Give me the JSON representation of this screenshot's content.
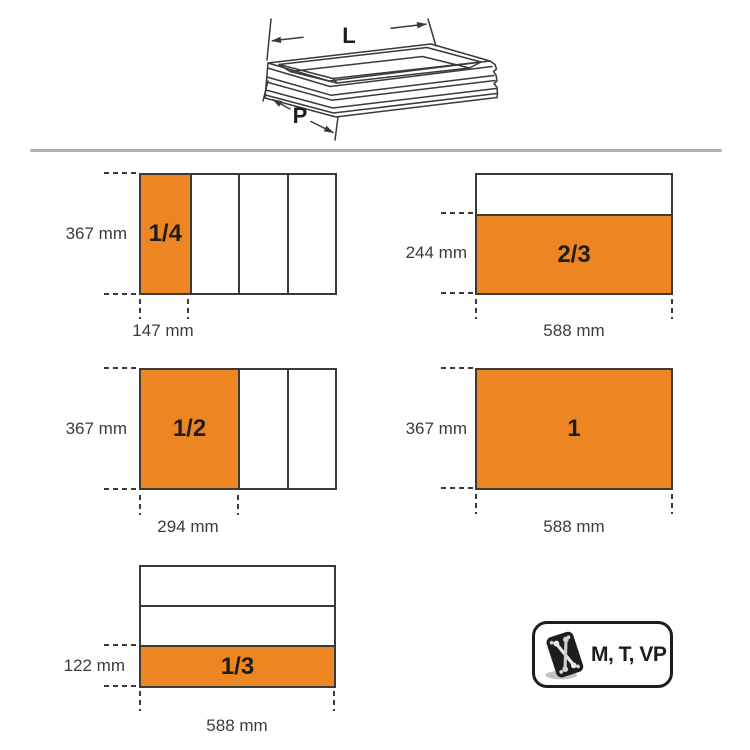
{
  "colors": {
    "accent_orange": "#ED8522",
    "line_dark": "#3A3A38",
    "divider_gray": "#AFAFAF",
    "text_dark": "#3C3C3A",
    "fraction_text": "#1D1D1B"
  },
  "drawer": {
    "length_label": "L",
    "depth_label": "P"
  },
  "modules": [
    {
      "fraction": "1/4",
      "side_label": "367 mm",
      "bottom_label": "147 mm",
      "split": "vertical",
      "sections": 4,
      "highlighted_index": 0
    },
    {
      "fraction": "2/3",
      "side_label": "244 mm",
      "bottom_label": "588 mm",
      "split": "horizontal",
      "sections": 2,
      "highlighted_index": 1
    },
    {
      "fraction": "1/2",
      "side_label": "367 mm",
      "bottom_label": "294 mm",
      "split": "vertical",
      "sections": 3,
      "highlighted_index": 0
    },
    {
      "fraction": "1",
      "side_label": "367 mm",
      "bottom_label": "588 mm",
      "split": "none",
      "sections": 1,
      "highlighted_index": 0
    },
    {
      "fraction": "1/3",
      "side_label": "122 mm",
      "bottom_label": "588 mm",
      "split": "horizontal",
      "sections": 3,
      "highlighted_index": 2
    }
  ],
  "badge": {
    "label": "M, T, VP",
    "icon": "wrench-tray-icon"
  }
}
